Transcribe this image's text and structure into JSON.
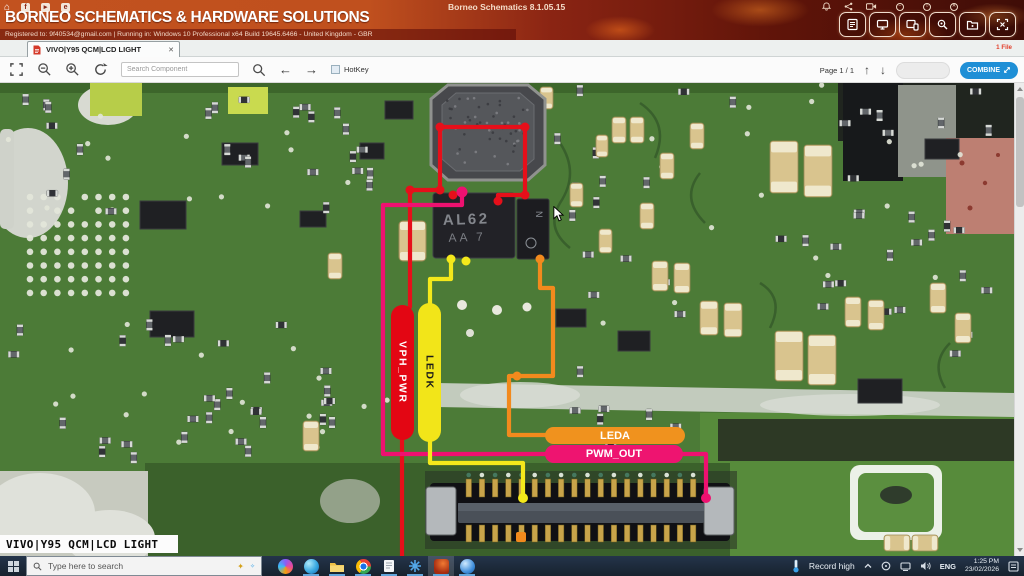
{
  "window": {
    "app_title": "Borneo Schematics 8.1.05.15"
  },
  "header": {
    "brand": "BORNEO SCHEMATICS & HARDWARE SOLUTIONS",
    "registration": "Registered to: 9f40534@gmail.com | Running in: Windows 10 Professional x64 Build 19645.6466 - United Kingdom - GBR",
    "files_badge": "1 File"
  },
  "tabs": [
    {
      "label": "VIVO|Y95 QCM|LCD LIGHT"
    }
  ],
  "toolbar": {
    "search_placeholder": "Search Component",
    "hotkey_label": "HotKey",
    "page_label": "Page 1 / 1",
    "combine_label": "COMBINE"
  },
  "board": {
    "overlay_label": "VIVO|Y95 QCM|LCD LIGHT",
    "chip_marking_line1": "AL62",
    "chip_marking_line2": "AA 7",
    "side_chip_marking": "N",
    "nets": [
      {
        "name": "VPH_PWR",
        "color": "#e30613"
      },
      {
        "name": "LEDK",
        "color": "#f2e519"
      },
      {
        "name": "LEDA",
        "color": "#f0921e"
      },
      {
        "name": "PWM_OUT",
        "color": "#ee1470"
      }
    ]
  },
  "taskbar": {
    "search_placeholder": "Type here to search",
    "weather_label": "Record high",
    "language": "ENG",
    "time": "1:25 PM",
    "date": "23/02/2026"
  }
}
